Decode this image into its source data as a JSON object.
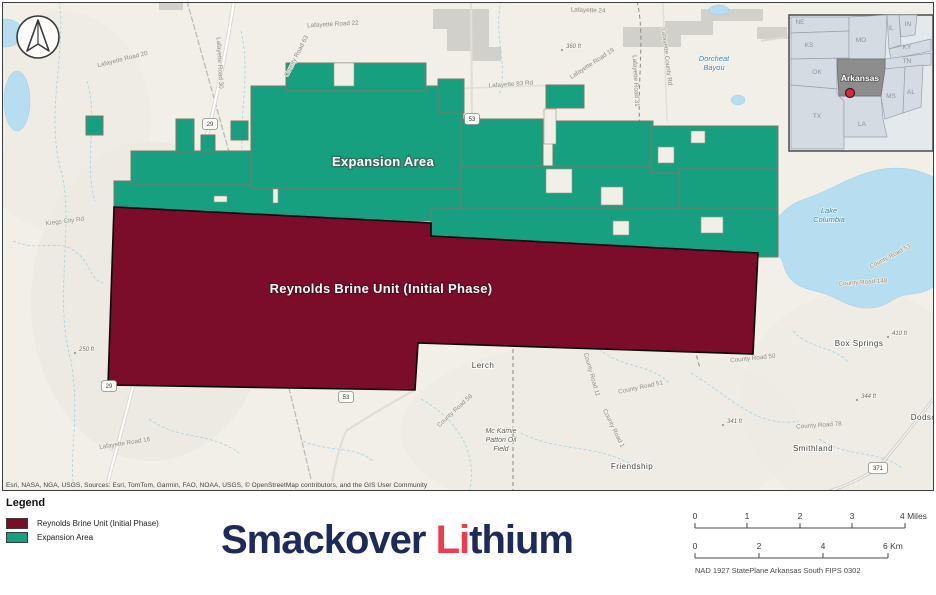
{
  "map": {
    "attribution": "Esri, NASA, NGA, USGS, Sources: Esri, TomTom, Garmin, FAO, NOAA, USGS, © OpenStreetMap contributors, and the GIS User Community",
    "colors": {
      "expansion": "#17a07f",
      "unit": "#7b0d2b",
      "parcel_border": "#857564",
      "basemap": "#f1efe8",
      "water": "#b6def0"
    },
    "overlays": [
      {
        "t": "Expansion Area",
        "x": 382,
        "y": 165,
        "cls": "overlay-exp"
      },
      {
        "t": "Reynolds Brine Unit (Initial Phase)",
        "x": 380,
        "y": 292,
        "cls": "overlay-unit"
      }
    ],
    "labels": [
      {
        "t": "Lafayette Road 20",
        "x": 122,
        "y": 60,
        "r": -14,
        "c": "road"
      },
      {
        "t": "Lafayette Road 30",
        "x": 217,
        "y": 62,
        "r": 87,
        "c": "road"
      },
      {
        "t": "Lafayette Road 22",
        "x": 332,
        "y": 25,
        "r": -3,
        "c": "road"
      },
      {
        "t": "Lafayette 24",
        "x": 587,
        "y": 11,
        "r": 2,
        "c": "road"
      },
      {
        "t": "Lafayette 83 Rd",
        "x": 510,
        "y": 85,
        "r": -4,
        "c": "road"
      },
      {
        "t": "County Road 63",
        "x": 297,
        "y": 56,
        "r": -63,
        "c": "road"
      },
      {
        "t": "Lafayette Road 19",
        "x": 592,
        "y": 64,
        "r": -33,
        "c": "road"
      },
      {
        "t": "Lafayette Road 31",
        "x": 633,
        "y": 80,
        "r": 87,
        "c": "road"
      },
      {
        "t": "Lafayette County Rd",
        "x": 664,
        "y": 56,
        "r": 83,
        "c": "road"
      },
      {
        "t": "Kregs City Rd",
        "x": 64,
        "y": 222,
        "r": -7,
        "c": "road"
      },
      {
        "t": "Lafayette Road 16",
        "x": 124,
        "y": 444,
        "r": -9,
        "c": "road"
      },
      {
        "t": "County Road 58",
        "x": 455,
        "y": 411,
        "r": -43,
        "c": "road"
      },
      {
        "t": "County Road 11",
        "x": 589,
        "y": 374,
        "r": 74,
        "c": "road"
      },
      {
        "t": "County Road 1",
        "x": 611,
        "y": 428,
        "r": 64,
        "c": "road"
      },
      {
        "t": "County Road 50",
        "x": 752,
        "y": 359,
        "r": -6,
        "c": "road"
      },
      {
        "t": "County Road 51",
        "x": 640,
        "y": 388,
        "r": -12,
        "c": "road"
      },
      {
        "t": "County Road 148",
        "x": 862,
        "y": 283,
        "r": -4,
        "c": "road"
      },
      {
        "t": "County Road 53",
        "x": 890,
        "y": 257,
        "r": -28,
        "c": "road"
      },
      {
        "t": "County Road 78",
        "x": 818,
        "y": 426,
        "r": -4,
        "c": "road"
      },
      {
        "t": "Lerch",
        "x": 482,
        "y": 367,
        "c": "place"
      },
      {
        "t": "Box Springs",
        "x": 858,
        "y": 345,
        "c": "place"
      },
      {
        "t": "Smithland",
        "x": 812,
        "y": 450,
        "c": "place"
      },
      {
        "t": "Friendship",
        "x": 631,
        "y": 468,
        "c": "place"
      },
      {
        "t": "Dodson",
        "x": 925,
        "y": 419,
        "c": "place"
      },
      {
        "lines": [
          "Mc Kamie",
          "Patton Oil",
          "Field"
        ],
        "x": 500,
        "y": 432,
        "c": "oil"
      },
      {
        "lines": [
          "Lake",
          "Columbia"
        ],
        "x": 828,
        "y": 212,
        "c": "water"
      },
      {
        "lines": [
          "Dorcheat",
          "Bayou"
        ],
        "x": 713,
        "y": 60,
        "c": "water"
      },
      {
        "t": "360 ft",
        "x": 565,
        "y": 47,
        "c": "elev",
        "dot": 1
      },
      {
        "t": "250 ft",
        "x": 78,
        "y": 350,
        "c": "elev",
        "dot": 1
      },
      {
        "t": "410 ft",
        "x": 891,
        "y": 334,
        "c": "elev",
        "dot": 1
      },
      {
        "t": "344 ft",
        "x": 860,
        "y": 397,
        "c": "elev",
        "dot": 1
      },
      {
        "t": "341 ft",
        "x": 726,
        "y": 422,
        "c": "elev",
        "dot": 1
      }
    ],
    "shields": [
      {
        "n": "29",
        "x": 209,
        "y": 123
      },
      {
        "n": "53",
        "x": 471,
        "y": 118
      },
      {
        "n": "53",
        "x": 345,
        "y": 396
      },
      {
        "n": "29",
        "x": 108,
        "y": 385
      },
      {
        "n": "371",
        "x": 877,
        "y": 467
      }
    ]
  },
  "inset": {
    "states": [
      {
        "t": "NE",
        "x": 799,
        "y": 23
      },
      {
        "t": "KS",
        "x": 808,
        "y": 46
      },
      {
        "t": "MO",
        "x": 860,
        "y": 41
      },
      {
        "t": "IL",
        "x": 890,
        "y": 29
      },
      {
        "t": "IN",
        "x": 907,
        "y": 25
      },
      {
        "t": "KY",
        "x": 906,
        "y": 48
      },
      {
        "t": "TN",
        "x": 906,
        "y": 62
      },
      {
        "t": "OK",
        "x": 816,
        "y": 73
      },
      {
        "t": "TX",
        "x": 816,
        "y": 117
      },
      {
        "t": "LA",
        "x": 861,
        "y": 125
      },
      {
        "t": "MS",
        "x": 890,
        "y": 97
      },
      {
        "t": "AL",
        "x": 910,
        "y": 93
      }
    ],
    "highlight": {
      "t": "Arkansas",
      "x": 859,
      "y": 80
    }
  },
  "legend": {
    "title": "Legend",
    "items": [
      {
        "label": "Reynolds Brine Unit (Initial Phase)",
        "color": "#7b0d2b"
      },
      {
        "label": "Expansion Area",
        "color": "#17a07f"
      }
    ]
  },
  "logo": {
    "prefix": "Smackover ",
    "accent": "Li",
    "suffix": "thium",
    "navy": "#1c2b5a",
    "red": "#ee3c4e"
  },
  "scalebar": {
    "bars": [
      {
        "unit": "miles",
        "y": 26,
        "x1": 9,
        "x2": 219,
        "ticks": [
          {
            "t": "0",
            "x": 9
          },
          {
            "t": "1",
            "x": 61
          },
          {
            "t": "2",
            "x": 114
          },
          {
            "t": "3",
            "x": 166
          },
          {
            "t": "4 Miles",
            "x": 219,
            "anchor": "start",
            "tx": 214
          }
        ]
      },
      {
        "unit": "km",
        "y": 56,
        "x1": 9,
        "x2": 202,
        "ticks": [
          {
            "t": "0",
            "x": 9
          },
          {
            "t": "2",
            "x": 73
          },
          {
            "t": "4",
            "x": 137
          },
          {
            "t": "6 Km",
            "x": 202,
            "anchor": "start",
            "tx": 197
          }
        ]
      }
    ],
    "datum": "NAD 1927 StatePlane Arkansas South FIPS 0302"
  }
}
